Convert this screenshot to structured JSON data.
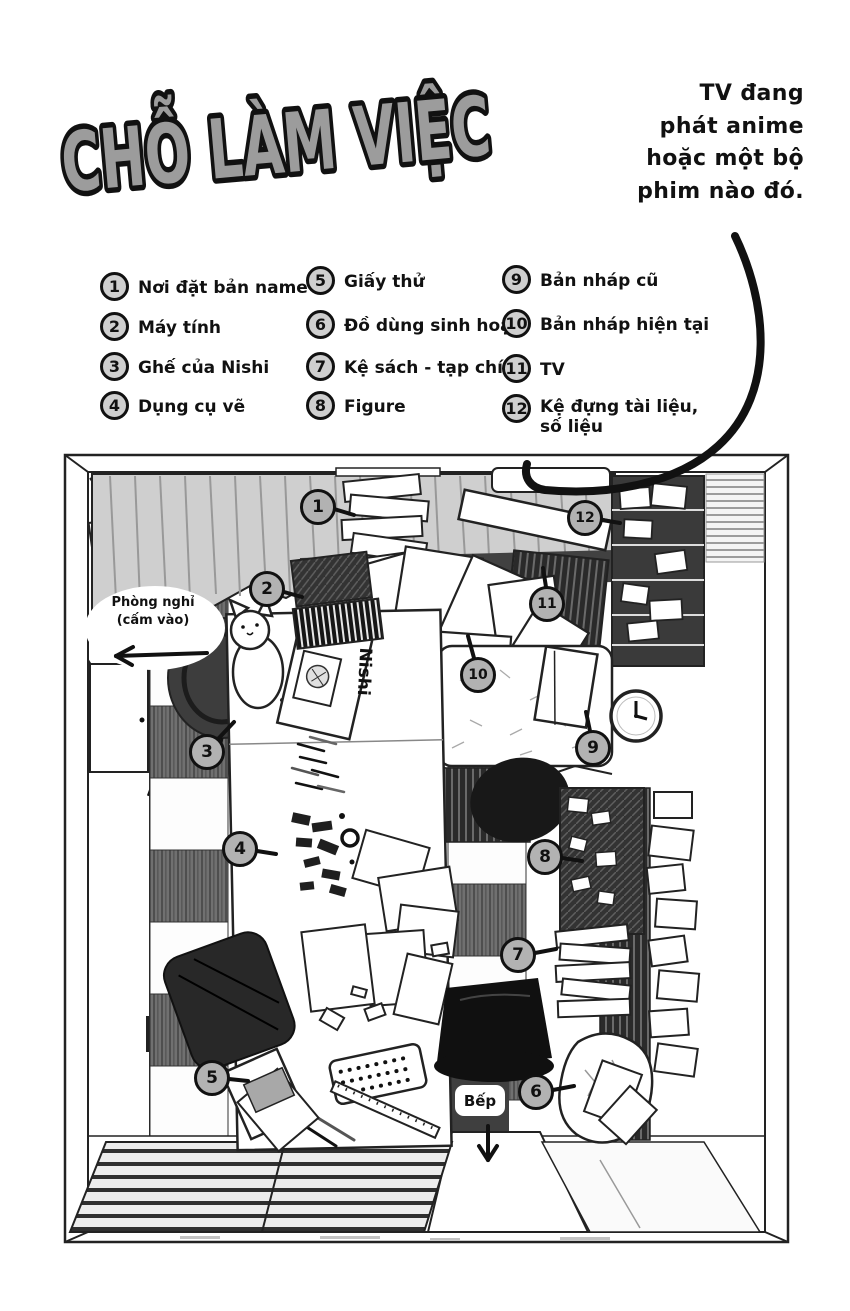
{
  "title": "CHỖ LÀM VIỆC",
  "note": {
    "lines": [
      "TV đang",
      "phát anime",
      "hoặc một bộ",
      "phim nào đó."
    ]
  },
  "legend": {
    "items": [
      {
        "number": "1",
        "label": "Nơi đặt bản name"
      },
      {
        "number": "2",
        "label": "Máy tính"
      },
      {
        "number": "3",
        "label": "Ghế của Nishi"
      },
      {
        "number": "4",
        "label": "Dụng cụ vẽ"
      },
      {
        "number": "5",
        "label": "Giấy thử"
      },
      {
        "number": "6",
        "label": "Đồ dùng sinh hoạt"
      },
      {
        "number": "7",
        "label": "Kệ sách - tạp chí"
      },
      {
        "number": "8",
        "label": "Figure"
      },
      {
        "number": "9",
        "label": "Bản nháp cũ"
      },
      {
        "number": "10",
        "label": "Bản nháp hiện tại"
      },
      {
        "number": "11",
        "label": "TV"
      },
      {
        "number": "12",
        "label": "Kệ đựng tài liệu,\nsố liệu"
      }
    ]
  },
  "map": {
    "labels": {
      "rest_room": "Phòng nghỉ\n(cấm vào)",
      "kitchen": "Bếp",
      "nishi_sign": "Nishi"
    }
  },
  "colors": {
    "title_fill": "#9c9c9c",
    "outline": "#111111",
    "callout_fill": "#b2b2b2",
    "legend_circle_fill": "#cfcfcf",
    "curtain": "#cfcfcf"
  }
}
